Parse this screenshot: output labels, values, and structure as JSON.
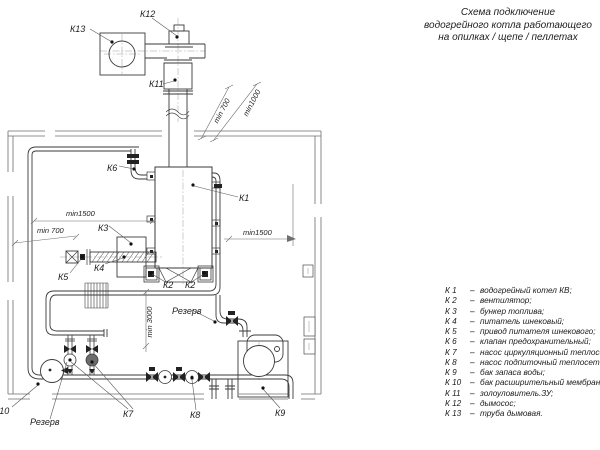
{
  "title": {
    "line1": "Схема подключение",
    "line2": "водогрейного котла работающего",
    "line3": "на опилках / щепе / пеллетах"
  },
  "labels": {
    "k1": "К1",
    "k2a": "К2",
    "k2b": "К2",
    "k3": "К3",
    "k4": "К4",
    "k5": "К5",
    "k6": "К6",
    "k7": "К7",
    "k8": "К8",
    "k9": "К9",
    "k10": "К10",
    "k11": "К11",
    "k12": "К12",
    "k13": "К13",
    "reserve_pump": "Резерв",
    "reserve_line": "Резерв"
  },
  "dimensions": {
    "top_min700": "min 700",
    "top_min1000": "min1000",
    "left_min1500": "min1500",
    "left_min700": "min 700",
    "right_min1500": "min1500",
    "bottom_min3000": "min 3000"
  },
  "legend": {
    "dash": "–",
    "items": [
      {
        "code": "К 1",
        "name": "водогрейный котел КВ;"
      },
      {
        "code": "К 2",
        "name": "вентилятор;"
      },
      {
        "code": "К 3",
        "name": "бункер топлива;"
      },
      {
        "code": "К 4",
        "name": "питатель шнековый;"
      },
      {
        "code": "К 5",
        "name": "привод питателя шнекового;"
      },
      {
        "code": "К 6",
        "name": "клапан предохранительный;"
      },
      {
        "code": "К 7",
        "name": "насос циркуляционный теплосети;"
      },
      {
        "code": "К 8",
        "name": "насос подпиточный теплосети;"
      },
      {
        "code": "К 9",
        "name": "бак запаса воды;"
      },
      {
        "code": "К 10",
        "name": "бак расширительный мембранный;"
      },
      {
        "code": "К 11",
        "name": "золоуловитель.ЗУ;"
      },
      {
        "code": "К 12",
        "name": "дымосос;"
      },
      {
        "code": "К 13",
        "name": "труба дымовая."
      }
    ]
  },
  "colors": {
    "line": "#3a3a3a",
    "wall": "#6e6e6e",
    "text": "#1c1c1c",
    "background": "#ffffff"
  }
}
